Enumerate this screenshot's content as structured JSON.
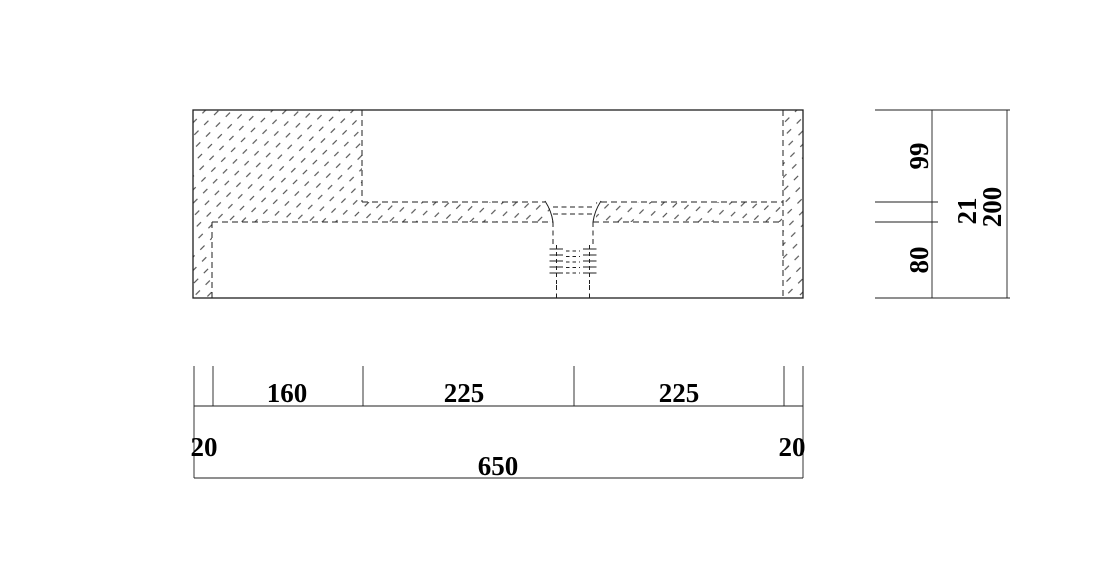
{
  "drawing": {
    "line_color": "#1f1f1f",
    "hatch_color": "#383838",
    "text_color": "#000000",
    "background": "#ffffff"
  },
  "dims": {
    "v_upper": "99",
    "v_strip": "21",
    "v_total": "200",
    "v_lower": "80",
    "h_left_wall": "20",
    "h_left": "160",
    "h_mid": "225",
    "h_right": "225",
    "h_right_wall": "20",
    "h_total": "650"
  }
}
